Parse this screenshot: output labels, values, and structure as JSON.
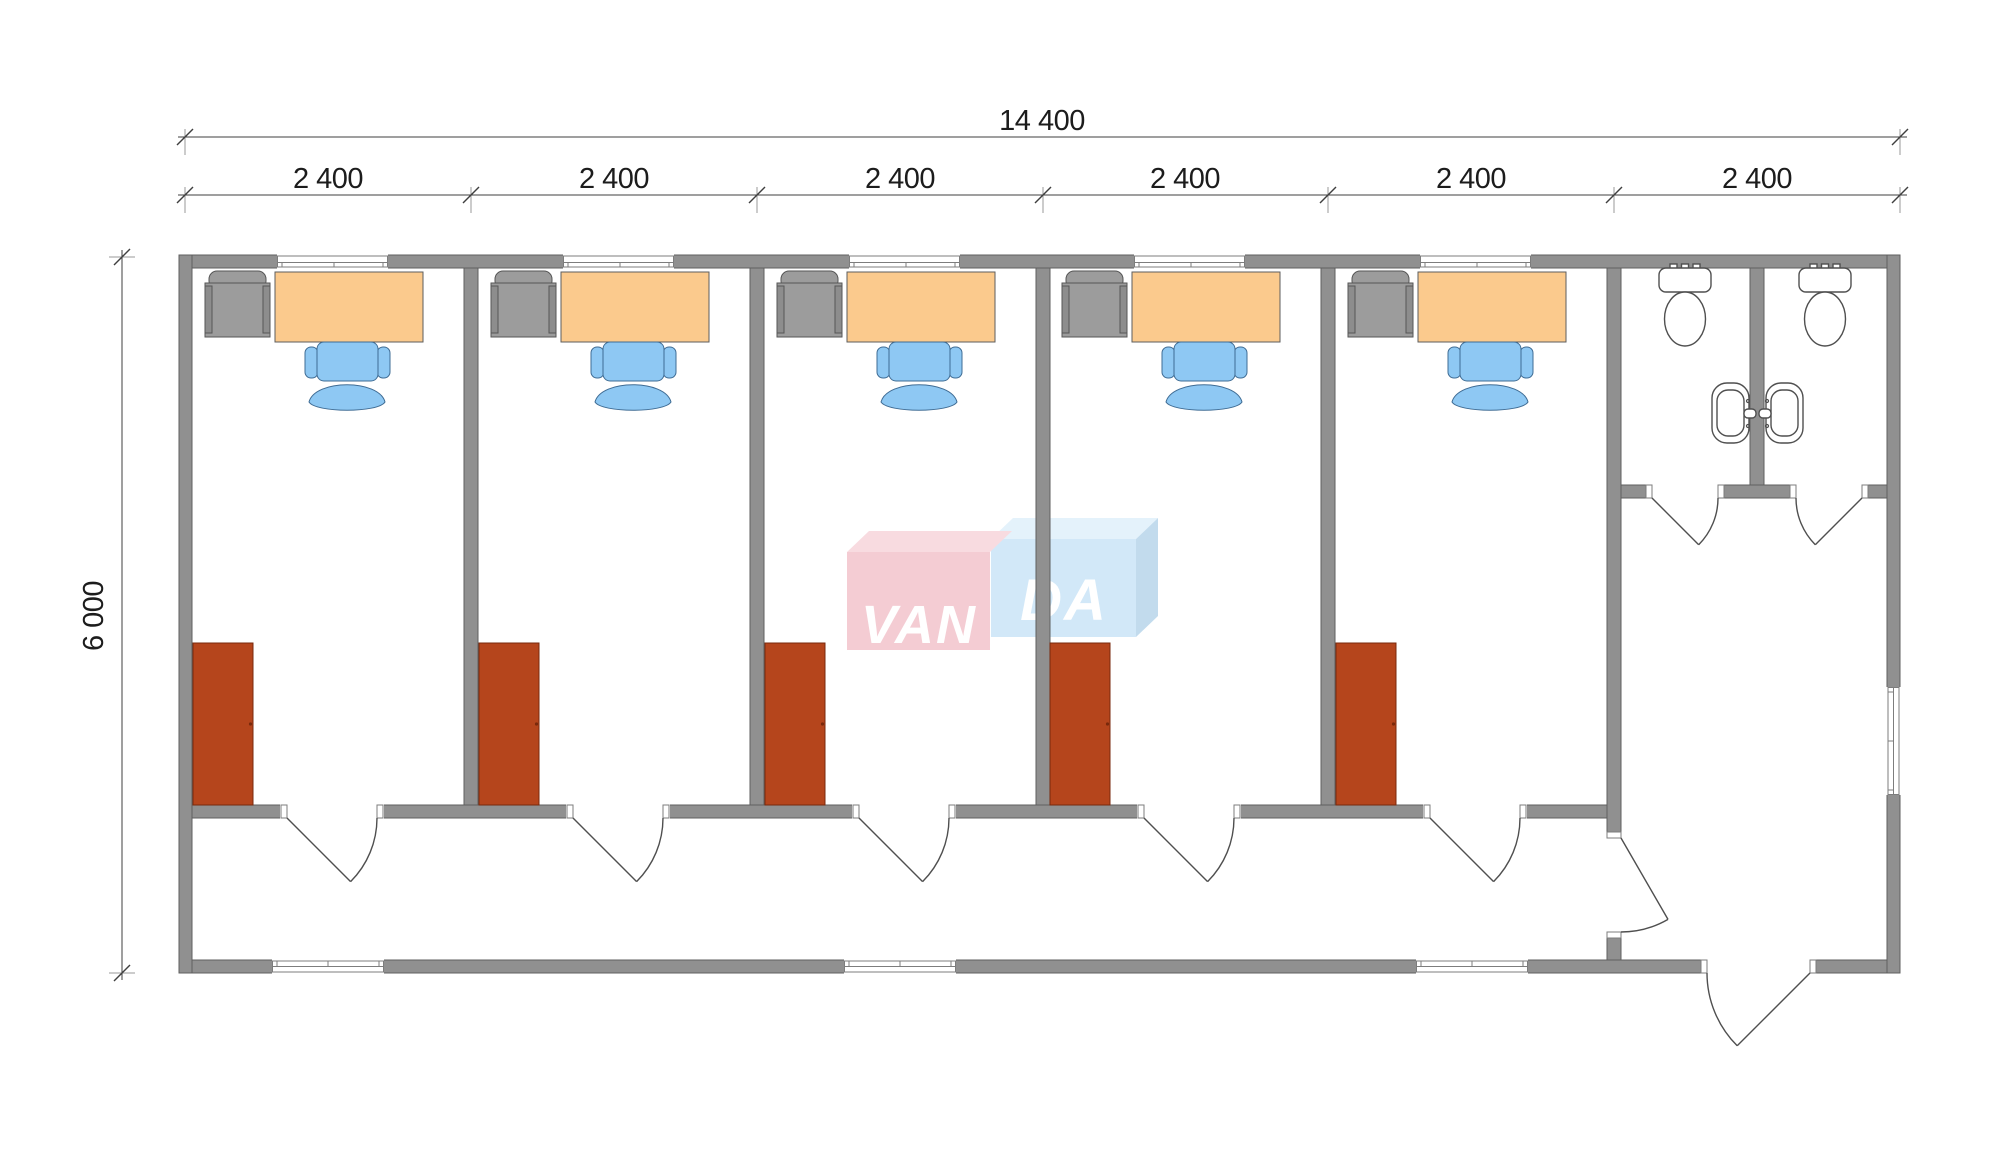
{
  "page": {
    "background": "#ffffff",
    "type": "architectural-floor-plan"
  },
  "dimensions": {
    "total_width_label": "14 400",
    "bay_labels": [
      "2 400",
      "2 400",
      "2 400",
      "2 400",
      "2 400",
      "2 400"
    ],
    "height_label": "6 000"
  },
  "watermark": {
    "brand": "VANDA",
    "left_text": "VAN",
    "right_text": "DA"
  },
  "plan": {
    "offices_count": 5,
    "office_furniture": [
      "armchair",
      "desk",
      "office-chair",
      "wardrobe"
    ],
    "sanitary_fixtures": [
      "toilet",
      "toilet",
      "sink",
      "sink"
    ],
    "openings": {
      "office_top_windows": 5,
      "bottom_windows": 3,
      "right_wall_window": 1,
      "office_doors": 5,
      "wc_stall_doors": 2,
      "corridor_lobby_door": 1,
      "entrance_door": 1
    }
  },
  "colors": {
    "wall": "#909090",
    "wall-line": "#5f5f5f",
    "opening-frame": "#7d7d7d",
    "door-line": "#4f4f4f",
    "fixture-line": "#4f4f4f",
    "desk": "#fbca8d",
    "desk-line": "#5e5e5e",
    "chair": "#8ec8f3",
    "chair-line": "#3f6c94",
    "armchair": "#9c9c9c",
    "armchair-rail": "#8d8d8d",
    "armchair-line": "#565656",
    "wardrobe": "#b5451c",
    "wardrobe-line": "#79290c",
    "dim-line": "#3f3f3f",
    "dim-text": "#1c1c1c",
    "logo-pink": "#f4c8d0",
    "logo-pink-top": "#f8d9de",
    "logo-blue": "#cfe7f8",
    "logo-blue-top": "#e2f1fb",
    "logo-blue-side": "#bdd9ec",
    "logo-text": "#ffffff"
  }
}
